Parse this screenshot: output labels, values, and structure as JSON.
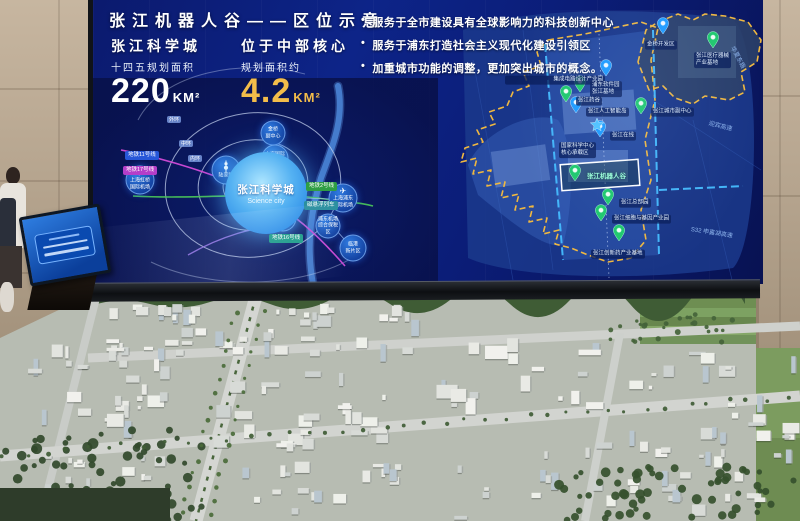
{
  "screen": {
    "title": "张江机器人谷——区位示意",
    "stats_left": {
      "title": "张江科学城",
      "subtitle": "十四五规划面积",
      "value": "220",
      "unit": "KM²"
    },
    "stats_right": {
      "title": "位于中部核心",
      "subtitle": "规划面积约",
      "value": "4.2",
      "unit": "KM²"
    },
    "bullets": [
      "服务于全市建设具有全球影响力的科技创新中心",
      "服务于浦东打造社会主义现代化建设引领区",
      "加重城市功能的调整，更加突出城市的概念。"
    ]
  },
  "left_map": {
    "science_city_label": "张江科学城",
    "science_city_en": "Science city",
    "nodes": [
      {
        "label": "上海虹桥\n国际机场",
        "icon": "plane"
      },
      {
        "label": "陆家嘴",
        "icon": "tower"
      },
      {
        "label": "金桥\n副中心",
        "icon": "dot"
      },
      {
        "label": "上海国际\n旅游度假区",
        "icon": "dot"
      },
      {
        "label": "迪士尼\n乐园",
        "icon": "castle"
      },
      {
        "label": "上海浦东\n国际机场",
        "icon": "plane"
      },
      {
        "label": "浦东机场\n综合保税区",
        "icon": "dot"
      },
      {
        "label": "临港\n新片区",
        "icon": "dot"
      }
    ],
    "line_labels": [
      {
        "text": "地铁11号线",
        "color": "#2757d8"
      },
      {
        "text": "地铁17号线",
        "color": "#b43ec9"
      },
      {
        "text": "地铁2号线",
        "color": "#2f9e44"
      },
      {
        "text": "磁悬浮列车",
        "color": "#2a8f9e"
      },
      {
        "text": "地铁16号线",
        "color": "#1f9e8a"
      }
    ],
    "ring_labels": [
      "外环",
      "中环",
      "内环"
    ]
  },
  "right_map": {
    "markers": [
      {
        "label": "集成电路设计产业园",
        "type": "blue"
      },
      {
        "label": "浦东软件园\n张江基地",
        "type": "green"
      },
      {
        "label": "张江药谷",
        "type": "green"
      },
      {
        "label": "张江人工智能岛",
        "type": "blue"
      },
      {
        "label": "张江城市副中心",
        "type": "green"
      },
      {
        "label": "张江在线",
        "type": "blue"
      },
      {
        "label": "张江总部园",
        "type": "green"
      },
      {
        "label": "张江细胞与基因产业园",
        "type": "green"
      },
      {
        "label": "张江创新药产业基地",
        "type": "green"
      },
      {
        "label": "金桥开发区",
        "type": "blue"
      },
      {
        "label": "张江医疗器械\n产业基地",
        "type": "green"
      }
    ],
    "core_label": "国家科学中心\n核心承载区",
    "robot_valley_label": "张江机器人谷",
    "road_labels": [
      "迎宾高速",
      "S32 申嘉湖高速",
      "华夏东路"
    ]
  },
  "colors": {
    "screen_bg": "#0c1d7a",
    "boundary_yellow": "#f0b840",
    "boundary_blue": "#45bcff",
    "marker_green": "#1fc96d",
    "marker_blue": "#1e9bff",
    "value_gold": "#f3bd4a"
  }
}
